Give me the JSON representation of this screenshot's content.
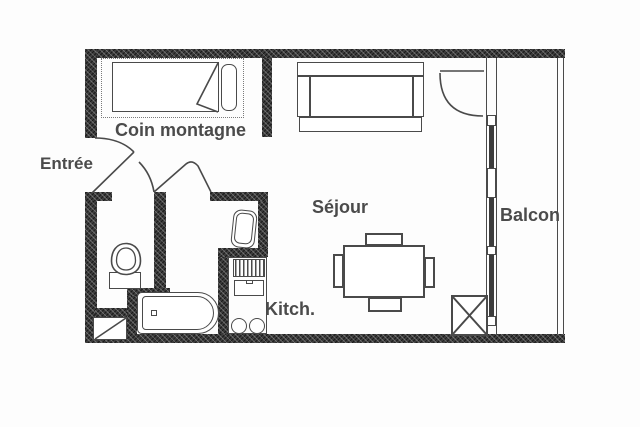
{
  "type": "floor-plan",
  "labels": {
    "entree": "Entrée",
    "coin_montagne": "Coin montagne",
    "sejour": "Séjour",
    "kitch": "Kitch.",
    "balcon": "Balcon"
  },
  "colors": {
    "background": "#fdfdfd",
    "wall": "#3c3c3c",
    "line": "#4a4a4a",
    "label": "#4b4b4b"
  },
  "fixtures": {
    "bed": "single bed with pillow and folded blanket",
    "sofa": "sofa bed",
    "dining_table": "table with four chairs",
    "bathtub": "bathtub",
    "toilet": "toilet",
    "sink": "washbasin",
    "kitchen_unit": "kitchenette with grill, oven and two burners",
    "window_wall": "glazed wall to balcony",
    "rail": "balcony railing",
    "shaft": "crossed service box"
  }
}
